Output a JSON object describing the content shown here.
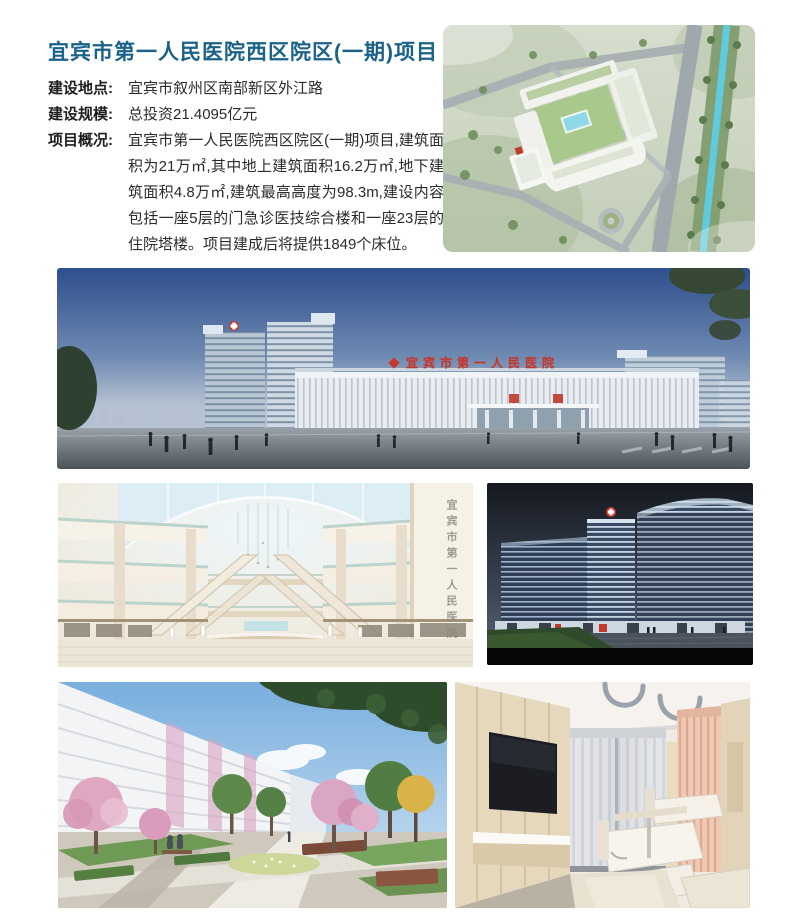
{
  "page": {
    "title": "宜宾市第一人民医院西区院区(一期)项目"
  },
  "info": {
    "rows": [
      {
        "label": "建设地点:",
        "value": "宜宾市叙州区南部新区外江路"
      },
      {
        "label": "建设规模:",
        "value": "总投资21.4095亿元"
      },
      {
        "label": "项目概况:",
        "value": "宜宾市第一人民医院西区院区(一期)项目,建筑面积为21万㎡,其中地上建筑面积16.2万㎡,地下建筑面积4.8万㎡,建筑最高高度为98.3m,建设内容包括一座5层的门急诊医技综合楼和一座23层的住院塔楼。项目建成后将提供1849个床位。"
      }
    ]
  },
  "signs": {
    "building_sign": "宜宾市第一人民医院",
    "atrium_wall_text": "宜宾市第一人民医院"
  },
  "images": {
    "aerial": {
      "alt": "鸟瞰效果图:医院园区、道路与河流"
    },
    "panorama": {
      "alt": "医院主楼沿街全景效果图"
    },
    "atrium": {
      "alt": "门诊大厅中庭效果图"
    },
    "night": {
      "alt": "住院塔楼夜景效果图"
    },
    "courtyard": {
      "alt": "庭院景观效果图"
    },
    "ward": {
      "alt": "病房室内效果图"
    }
  },
  "colors": {
    "accent_teal": "#1a6287",
    "sign_red": "#c5372c",
    "text_dark": "#262626"
  }
}
